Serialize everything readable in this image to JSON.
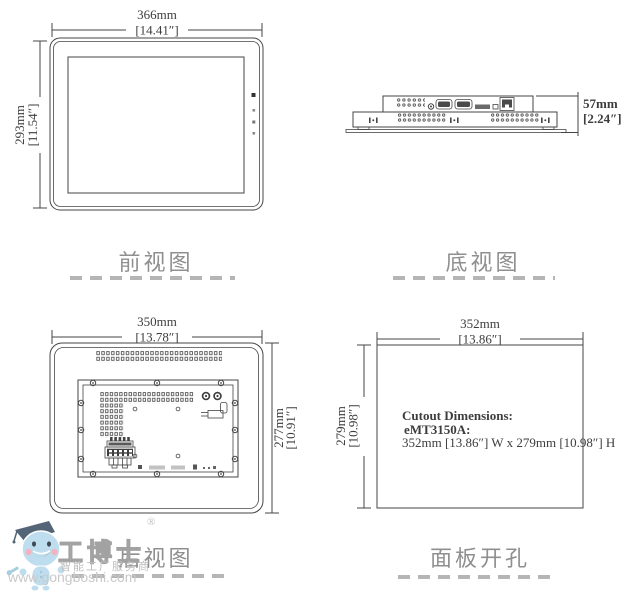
{
  "views": {
    "front": {
      "label": "前视图",
      "width_mm": "366mm",
      "width_in": "[14.41″]",
      "height_mm": "293mm",
      "height_in": "[11.54″]"
    },
    "bottom": {
      "label": "底视图",
      "depth_mm": "57mm",
      "depth_in": "[2.24″]"
    },
    "rear": {
      "label": "后视图",
      "width_mm": "350mm",
      "width_in": "[13.78″]",
      "height_mm": "277mm",
      "height_in": "[10.91″]"
    },
    "cutout": {
      "label": "面板开孔",
      "width_mm": "352mm",
      "width_in": "[13.86″]",
      "height_mm": "279mm",
      "height_in": "[10.98″]",
      "note_title": "Cutout  Dimensions:",
      "note_model": "eMT3150A:",
      "note_size": "352mm [13.86″] W x 279mm [10.98″] H"
    }
  },
  "watermark": {
    "brand": "工博士",
    "registered": "®",
    "tagline": "智能工厂服务商",
    "url": "www.gongboshi.com"
  },
  "colors": {
    "line": "#454545",
    "label_gray": "#8f8f8f",
    "dash_gray": "#b5b5b5",
    "watermark_blue": "#b9dcee",
    "watermark_text": "#c9c9c9"
  }
}
